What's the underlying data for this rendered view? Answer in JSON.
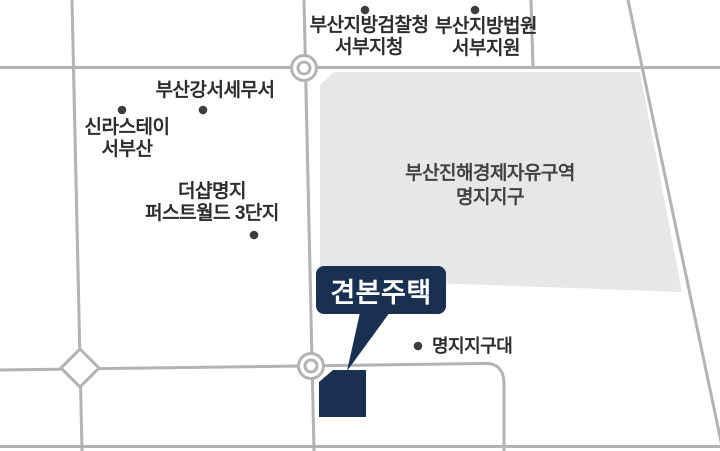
{
  "theme": {
    "background": "#ffffff",
    "road": "#b3b3b3",
    "zone_fill": "#e7e7e9",
    "navy": "#1a3050",
    "dot": "#3d3d3d",
    "text": "#2d2d2d",
    "zone_text": "#424242",
    "callout_text": "#ffffff"
  },
  "labels": {
    "prosecutors": {
      "line1": "부산지방검찰청",
      "line2": "서부지청"
    },
    "court": {
      "line1": "부산지방법원",
      "line2": "서부지원"
    },
    "tax_office": {
      "text": "부산강서세무서"
    },
    "shilla_stay": {
      "line1": "신라스테이",
      "line2": "서부산"
    },
    "the_sharp": {
      "line1": "더샵명지",
      "line2": "퍼스트월드 3단지"
    },
    "economic_zone": {
      "line1": "부산진해경제자유구역",
      "line2": "명지지구"
    },
    "police_substation": {
      "text": "명지지구대"
    },
    "model_house": {
      "text": "견본주택"
    }
  }
}
